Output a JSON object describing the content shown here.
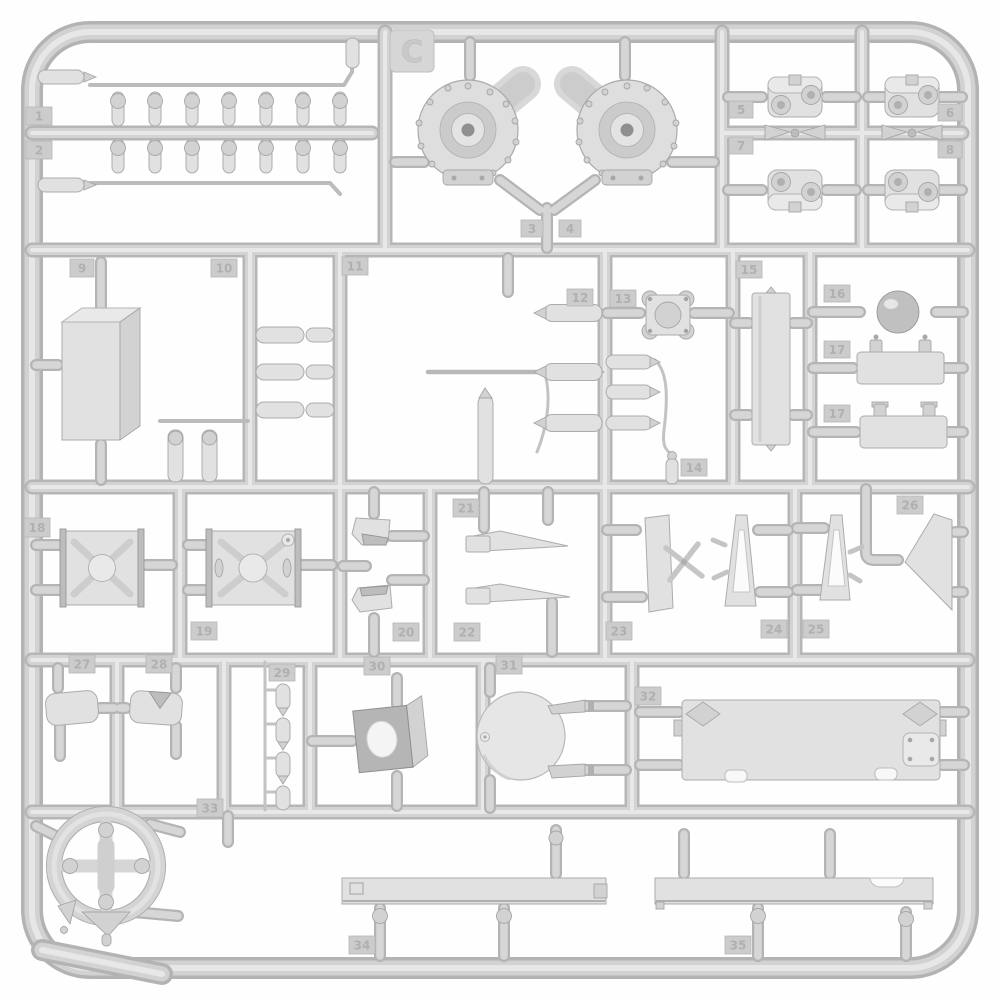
{
  "sprue": {
    "letter": "C",
    "background_color": "#ffffff",
    "plastic_base_color": "#c9c9c9",
    "plastic_highlight_color": "#e8e8e8",
    "plastic_shadow_color": "#a8a8a8",
    "part_number_tags": [
      "1",
      "2",
      "3",
      "4",
      "5",
      "6",
      "7",
      "8",
      "9",
      "10",
      "11",
      "12",
      "13",
      "14",
      "15",
      "16",
      "17",
      "17",
      "18",
      "19",
      "20",
      "21",
      "22",
      "23",
      "24",
      "25",
      "26",
      "27",
      "28",
      "29",
      "30",
      "31",
      "32",
      "33",
      "34",
      "35"
    ],
    "parts": [
      {
        "tag": "1",
        "name": "small-cylinder-row-upper"
      },
      {
        "tag": "2",
        "name": "small-cylinder-row-lower"
      },
      {
        "tag": "3",
        "name": "final-drive-housing-left"
      },
      {
        "tag": "4",
        "name": "final-drive-housing-right"
      },
      {
        "tag": "5",
        "name": "suspension-yoke"
      },
      {
        "tag": "6",
        "name": "suspension-yoke"
      },
      {
        "tag": "7",
        "name": "suspension-yoke"
      },
      {
        "tag": "8",
        "name": "suspension-yoke"
      },
      {
        "tag": "9",
        "name": "stowage-box"
      },
      {
        "tag": "10",
        "name": "paired-cylinders"
      },
      {
        "tag": "11",
        "name": "antenna-and-barrel-set"
      },
      {
        "tag": "12",
        "name": "bolted-square-plate"
      },
      {
        "tag": "13",
        "name": "bullet-cylinders"
      },
      {
        "tag": "14",
        "name": "small-bottle"
      },
      {
        "tag": "15",
        "name": "long-flat-plate"
      },
      {
        "tag": "16",
        "name": "sphere"
      },
      {
        "tag": "17",
        "name": "clamp-plate"
      },
      {
        "tag": "18",
        "name": "x-ribbed-panel"
      },
      {
        "tag": "19",
        "name": "x-ribbed-panel-with-ports"
      },
      {
        "tag": "20",
        "name": "periscope-pair"
      },
      {
        "tag": "21",
        "name": "fender-wedge-upper"
      },
      {
        "tag": "22",
        "name": "fender-wedge-lower"
      },
      {
        "tag": "23",
        "name": "tapered-plate-with-cross"
      },
      {
        "tag": "24",
        "name": "triangular-bracket"
      },
      {
        "tag": "25",
        "name": "triangular-bracket"
      },
      {
        "tag": "26",
        "name": "large-wedge-plate"
      },
      {
        "tag": "27",
        "name": "round-hatch"
      },
      {
        "tag": "28",
        "name": "round-hatch-notched"
      },
      {
        "tag": "29",
        "name": "bullet-set-of-four"
      },
      {
        "tag": "30",
        "name": "mount-plate-with-hole"
      },
      {
        "tag": "31",
        "name": "circular-turret-floor"
      },
      {
        "tag": "32",
        "name": "engine-deck-panel"
      },
      {
        "tag": "33",
        "name": "spoked-ring-wheel"
      },
      {
        "tag": "34",
        "name": "fender-strip-left"
      },
      {
        "tag": "35",
        "name": "fender-strip-right"
      }
    ]
  }
}
